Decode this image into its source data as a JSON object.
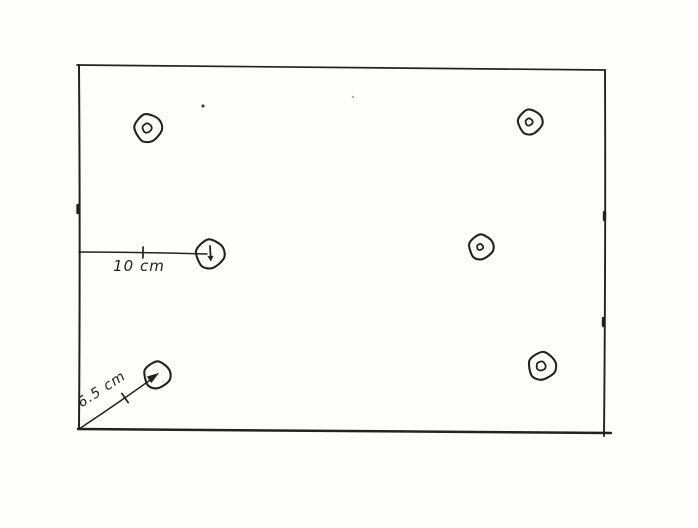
{
  "scene": {
    "width": 698,
    "height": 528,
    "paper_color": "#fdfdfc",
    "ink_color": "#222222",
    "description": "Hand-drawn rectangular plate sketch with six marked hole positions and two dimension call-outs"
  },
  "board": {
    "edges": {
      "top": {
        "from": [
          77,
          65
        ],
        "to": [
          605,
          70
        ]
      },
      "right": {
        "from": [
          605,
          70
        ],
        "to": [
          604,
          436
        ]
      },
      "bottom": {
        "from": [
          78,
          429
        ],
        "to": [
          611,
          433
        ]
      },
      "left": {
        "from": [
          79,
          65
        ],
        "to": [
          79,
          429
        ]
      }
    },
    "edge_nubs": [
      {
        "x": 78,
        "y": 209
      },
      {
        "x": 604.5,
        "y": 216
      },
      {
        "x": 603.5,
        "y": 322
      }
    ]
  },
  "holes": [
    {
      "name": "hole-top-left",
      "cx": 148,
      "cy": 128,
      "r": 13.5,
      "inner_r": 4.5
    },
    {
      "name": "hole-top-right",
      "cx": 530,
      "cy": 122,
      "r": 12,
      "inner_r": 3.5
    },
    {
      "name": "hole-mid-left",
      "cx": 210,
      "cy": 254,
      "r": 14,
      "inner_r": 0,
      "marker": "down-arrow"
    },
    {
      "name": "hole-mid-right",
      "cx": 481,
      "cy": 247,
      "r": 12,
      "inner_r": 3
    },
    {
      "name": "hole-bottom-left",
      "cx": 157,
      "cy": 375,
      "r": 13,
      "inner_r": 0
    },
    {
      "name": "hole-bottom-right",
      "cx": 542,
      "cy": 366,
      "r": 13.5,
      "inner_r": 4.5
    }
  ],
  "dimensions": [
    {
      "name": "dimension-10cm",
      "label": "10 cm",
      "from": [
        79,
        252
      ],
      "to": [
        207,
        254
      ],
      "tick": [
        143,
        252.5
      ],
      "label_x": 139,
      "label_y": 271,
      "label_rotation": 0,
      "font_size": 15
    },
    {
      "name": "dimension-6-5cm",
      "label": "6.5 cm",
      "from": [
        79,
        429
      ],
      "to": [
        153,
        378
      ],
      "arrow_tip": [
        159,
        373
      ],
      "tick": [
        125,
        398
      ],
      "label_x": 104,
      "label_y": 393,
      "label_rotation": -33,
      "font_size": 14
    }
  ],
  "stray_marks": [
    {
      "x": 203,
      "y": 106,
      "r": 1.6,
      "opacity": 0.85
    },
    {
      "x": 353,
      "y": 97,
      "r": 1.2,
      "opacity": 0.35
    }
  ]
}
